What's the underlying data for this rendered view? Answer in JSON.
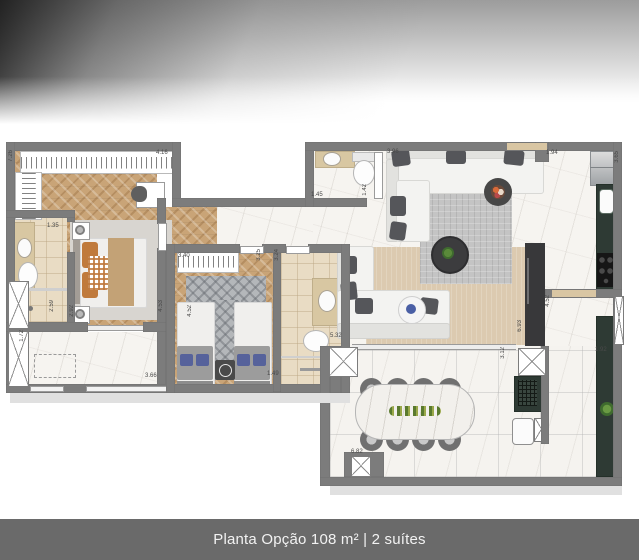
{
  "banner": {
    "title": "Planta Opção 108 m² | 2 suítes"
  },
  "plan": {
    "measurements": [
      "7.26",
      "4.16",
      "1.35",
      "2.59",
      "2.92",
      "4.53",
      "1.72",
      "3.66",
      "3.40",
      "3.25",
      "3.24",
      "1.49",
      "4.52",
      "1.45",
      "1.42",
      "3.96",
      "5.32",
      "6.93",
      "3.12",
      "4.52",
      "1.94",
      "3.65",
      "1.92",
      "6.82"
    ]
  },
  "colors": {
    "wall": "#7c7c7c",
    "wood_floor": "#c9a477",
    "marble_floor": "#f6f4f0",
    "bath_tile": "#e9dcc4",
    "counter_green": "#2e3a34",
    "banner_bg": "#6a6a6a",
    "pillow_orange": "#c07a3c",
    "pillow_navy": "#56629b"
  }
}
